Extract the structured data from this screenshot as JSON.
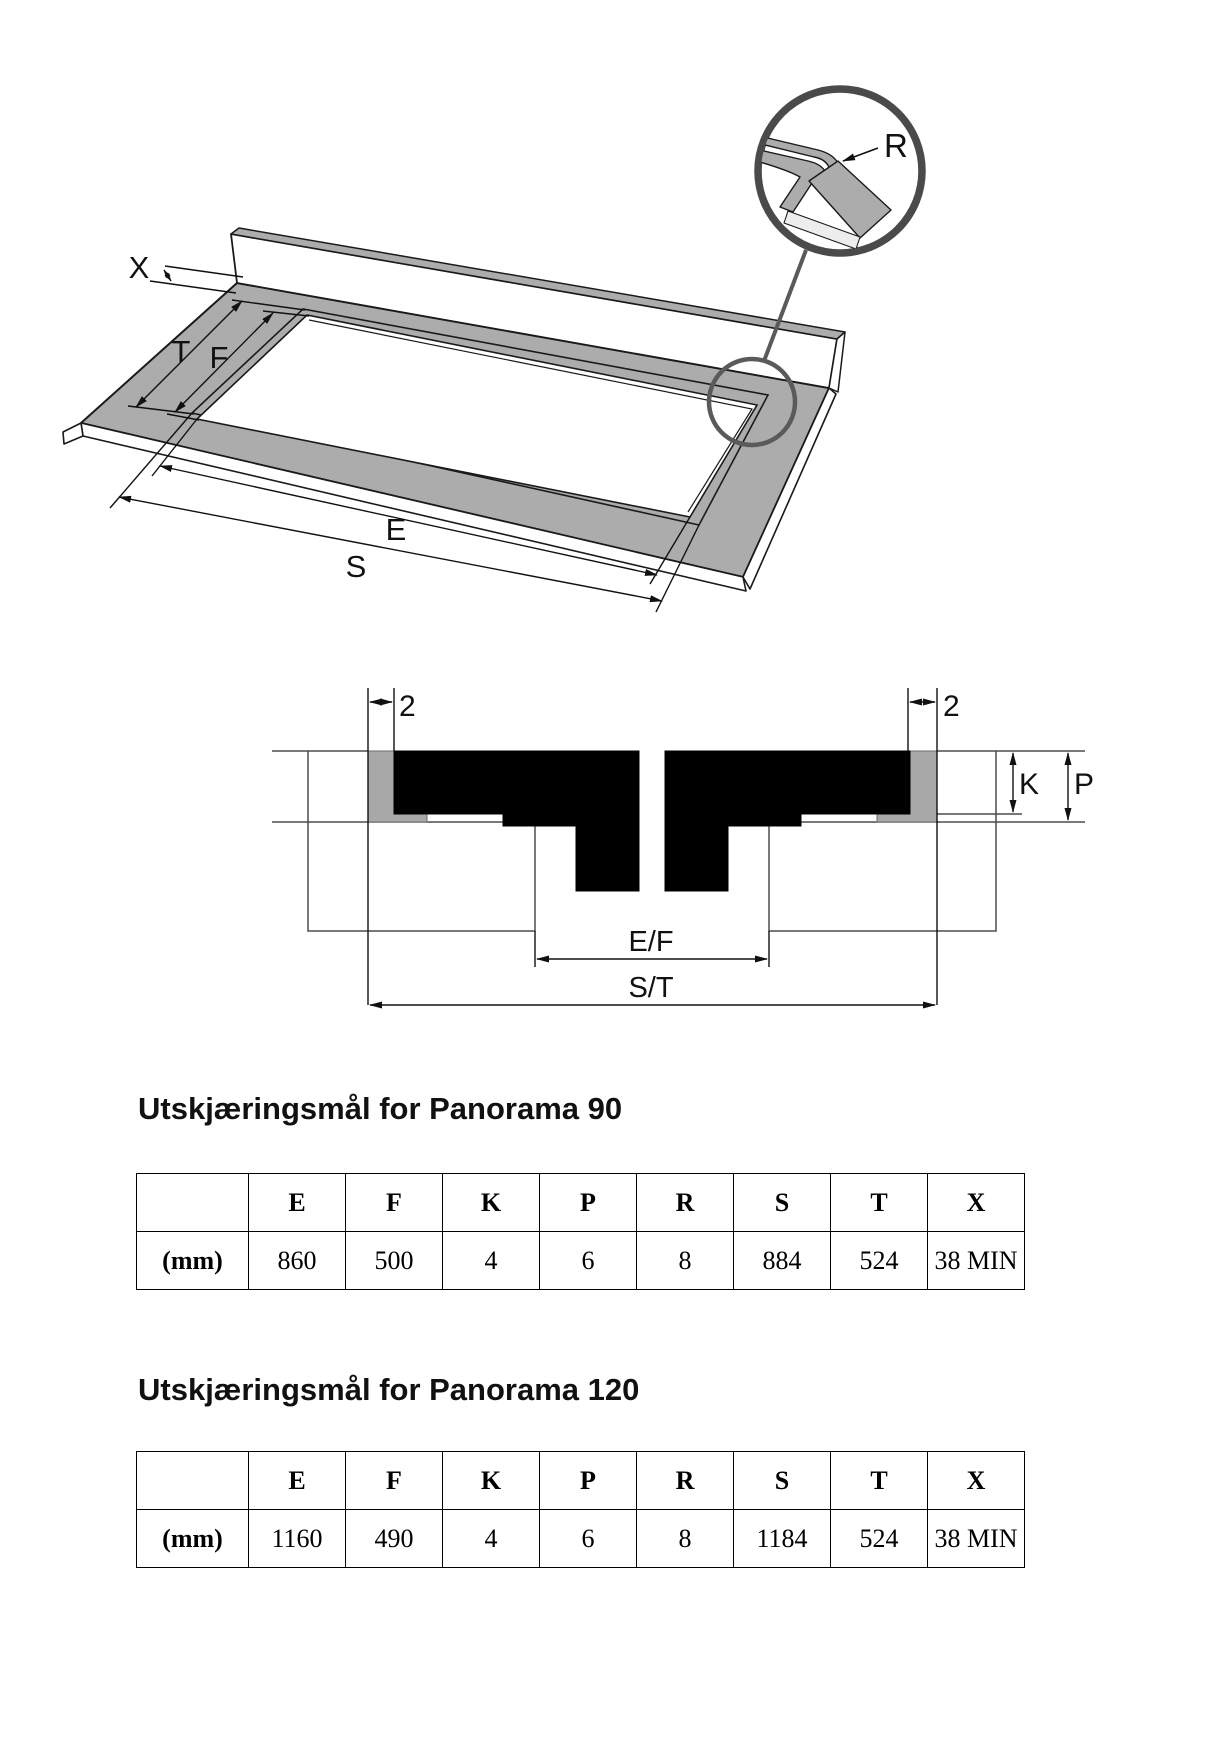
{
  "fig3d": {
    "labels": {
      "x": "X",
      "t": "T",
      "f": "F",
      "e": "E",
      "s": "S",
      "r": "R"
    },
    "colors": {
      "slab_gray": "#ACACAC",
      "line": "#1A1A1A",
      "detail_ring": "#4A4A4A"
    }
  },
  "cross_section": {
    "labels": {
      "left_gap": "2",
      "right_gap": "2",
      "k": "K",
      "p": "P",
      "inner_width": "E/F",
      "outer_width": "S/T"
    }
  },
  "sections": [
    {
      "title": "Utskjæringsmål for Panorama 90",
      "table": {
        "unit_label": "(mm)",
        "headers": [
          "E",
          "F",
          "K",
          "P",
          "R",
          "S",
          "T",
          "X"
        ],
        "values": [
          "860",
          "500",
          "4",
          "6",
          "8",
          "884",
          "524",
          "38 MIN"
        ]
      }
    },
    {
      "title": "Utskjæringsmål for Panorama 120",
      "table": {
        "unit_label": "(mm)",
        "headers": [
          "E",
          "F",
          "K",
          "P",
          "R",
          "S",
          "T",
          "X"
        ],
        "values": [
          "1160",
          "490",
          "4",
          "6",
          "8",
          "1184",
          "524",
          "38 MIN"
        ]
      }
    }
  ]
}
